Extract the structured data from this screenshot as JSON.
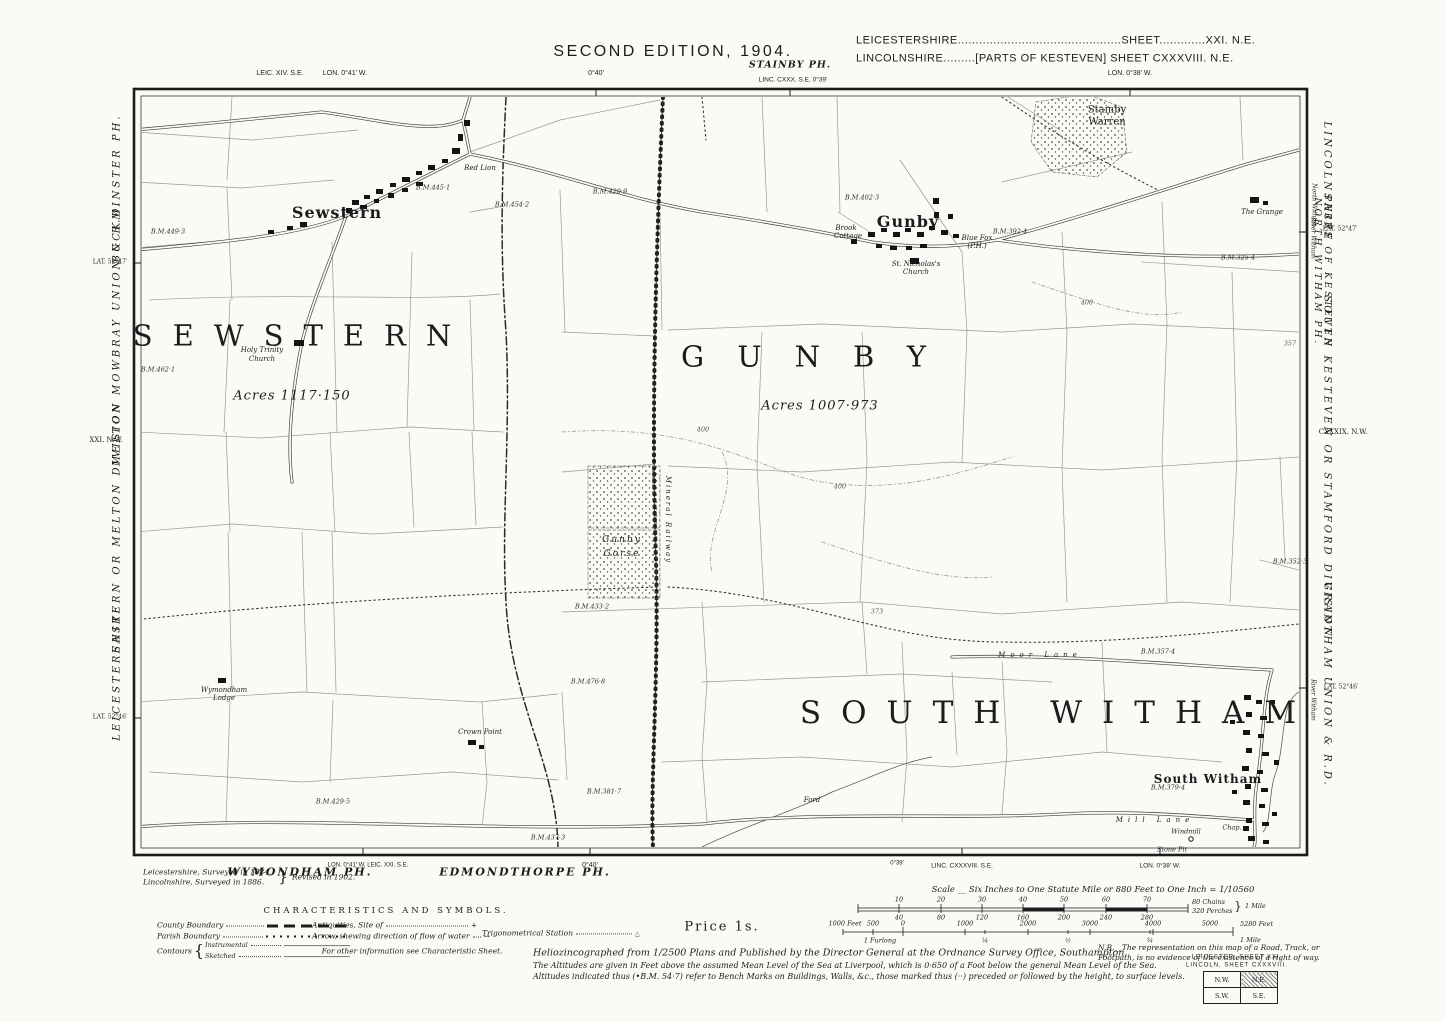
{
  "header": {
    "edition": "SECOND EDITION, 1904.",
    "county_line1": "LEICESTERSHIRE..............................................SHEET.............XXI. N.E.",
    "county_line2": "LINCOLNSHIRE.........[PARTS OF KESTEVEN]   SHEET   CXXXVIII. N.E.",
    "top_left_sheet": "LEIC. XIV. S.E.",
    "top_left_lon": "LON. 0°41′ W.",
    "top_lon_40": "0°40′",
    "stainby_parish": "STAINBY PH.",
    "stainby_sheet": "LINC. CXXX. S.E.   0°39′",
    "top_lon_38": "LON. 0°38′ W."
  },
  "margin_left": {
    "buckminster": "BUCKMINSTER PH.",
    "lat_47": "LAT. 52°47′",
    "melton_union": "MELTON MOWBRAY UNION & R.D.",
    "sheet_nw": "XXI. N.W.",
    "division": "EASTERN OR MELTON DIVISION",
    "county": "LEICESTERSHIRE",
    "lat_46": "LAT. 52°46′"
  },
  "margin_right": {
    "county": "LINCOLNSHIRE",
    "north_witham_small": "North Witham",
    "river_witham_top": "River Witham",
    "lat_47": "LAT. 52°47′",
    "parts1": "PARTS OF KESTEVEN",
    "parts2": "NORTH WITHAM PH.",
    "division": "SOUTH KESTEVEN OR STAMFORD DIVISION",
    "sheet_nw": "CXXXIX. N.W.",
    "union": "GRANTHAM UNION & R.D.",
    "river_witham_bottom": "River Witham",
    "lat_46": "LAT. 52°46′"
  },
  "footer_edge": {
    "wymondham": "WYMONDHAM PH.",
    "wymondham_sheet": "LON. 0°41′ W.   LEIC. XXI. S.E.",
    "edmondthorpe": "EDMONDTHORPE PH.",
    "lon_40": "0°40′",
    "lon_39": "0°39′",
    "linc_sheet": "LINC. CXXXVIII. S.E.",
    "lon_38": "LON. 0°38′ W."
  },
  "notes": {
    "surveyed1": "Leicestershire,   Surveyed in 1884.",
    "surveyed2": "Lincolnshire,   Surveyed in 1886.",
    "brace": "}",
    "revised": "Revised in 1902.",
    "price": "Price 1s.",
    "publication": "Heliozincographed from 1/2500 Plans and Published by the Director General at the Ordnance Survey Office, Southampton.",
    "nb": "N.B.__The representation on this map of a Road, Track, or Footpath, is no evidence of the existence of a right of way.",
    "altitude1": "The Altitudes are given in Feet above the assumed Mean Level of the Sea at Liverpool, which is 0·650 of a Foot below the general Mean Level of the Sea.",
    "altitude2": "Altitudes indicated thus (•B.M. 54·7) refer to Bench Marks on Buildings, Walls, &c., those marked thus (··) preceded or followed by the height, to surface levels."
  },
  "legend": {
    "title": "CHARACTERISTICS AND SYMBOLS.",
    "county_boundary": "County Boundary",
    "parish_boundary": "Parish Boundary",
    "contours": "Contours",
    "contours_brace": "{",
    "instrumental": "Instrumental",
    "sketched": "Sketched",
    "antiquities": "Antiquities, Site of",
    "antiquities_symbol": "+",
    "arrow": "Arrow, shewing direction of flow of water",
    "arrow_symbol": "→",
    "trig": "Trigonometrical Station",
    "trig_symbol": "△",
    "more_info": "For other information see Characteristic Sheet."
  },
  "scalebar": {
    "title": "Scale __ Six Inches to One Statute Mile or 880 Feet to One Inch = 1/10560",
    "chains_top": [
      "10",
      "20",
      "30",
      "40",
      "50",
      "60",
      "70"
    ],
    "chains_right1": "80 Chains",
    "chains_right2": "320 Perches",
    "brace": "}",
    "mile_right": "1 Mile",
    "perches_bottom": [
      "40",
      "80",
      "120",
      "160",
      "200",
      "240",
      "280"
    ],
    "feet_left": [
      "1000 Feet",
      "500",
      "0"
    ],
    "feet_top": [
      "1000",
      "2000",
      "3000",
      "4000",
      "5000"
    ],
    "feet_right": "5280 Feet",
    "furlong": "1 Furlong",
    "fractions": [
      "¼",
      "½",
      "¾"
    ],
    "mile_right2": "1 Mile"
  },
  "index_box": {
    "title1": "LEICESTER, SHEET XXI.",
    "title2": "LINCOLN, SHEET CXXXVIII.",
    "nw": "N.W.",
    "ne": "N.E.",
    "sw": "S.W.",
    "se": "S.E."
  },
  "map": {
    "parish_sewstern": "SEWSTERN",
    "parish_gunby": "GUNBY",
    "parish_south_witham": "SOUTH  WITHAM",
    "acres_sewstern": "Acres 1117·150",
    "acres_gunby": "Acres 1007·973",
    "village_sewstern": "Sewstern",
    "village_gunby": "Gunby",
    "village_south_witham": "South Witham",
    "holy_trinity1": "Holy Trinity",
    "holy_trinity2": "Church",
    "red_lion": "Red Lion",
    "st_nicholas1": "St. Nicholas's",
    "st_nicholas2": "Church",
    "blue_fox1": "Blue Fox",
    "blue_fox2": "(P.H.)",
    "brook1": "Brook",
    "brook2": "Cottage",
    "stainby1": "Stainby",
    "stainby2": "Warren",
    "gorse1": "Gunby",
    "gorse2": "Gorse",
    "mineral_railway": "Mineral Railway",
    "crown_point": "Crown Point",
    "wymondham1": "Wymondham",
    "wymondham2": "Lodge",
    "the_grange": "The Grange",
    "ford": "Ford",
    "moor_lane": "Moor Lane",
    "mill_lane": "Mill Lane",
    "windmill": "Windmill",
    "chapel": "Chap.",
    "stone_pit": "Stone Pit",
    "benchmarks": [
      "B.M.454·2",
      "B.M.445·1",
      "B.M.420·9",
      "B.M.449·3",
      "B.M.462·1",
      "B.M.433·2",
      "B.M.476·8",
      "B.M.381·7",
      "B.M.429·5",
      "B.M.437·3",
      "B.M.402·3",
      "B.M.392·4",
      "B.M.325·4",
      "B.M.357·4",
      "B.M.352·3",
      "B.M.379·4"
    ],
    "spots": [
      "373",
      "357",
      "400",
      "400",
      "400"
    ]
  }
}
